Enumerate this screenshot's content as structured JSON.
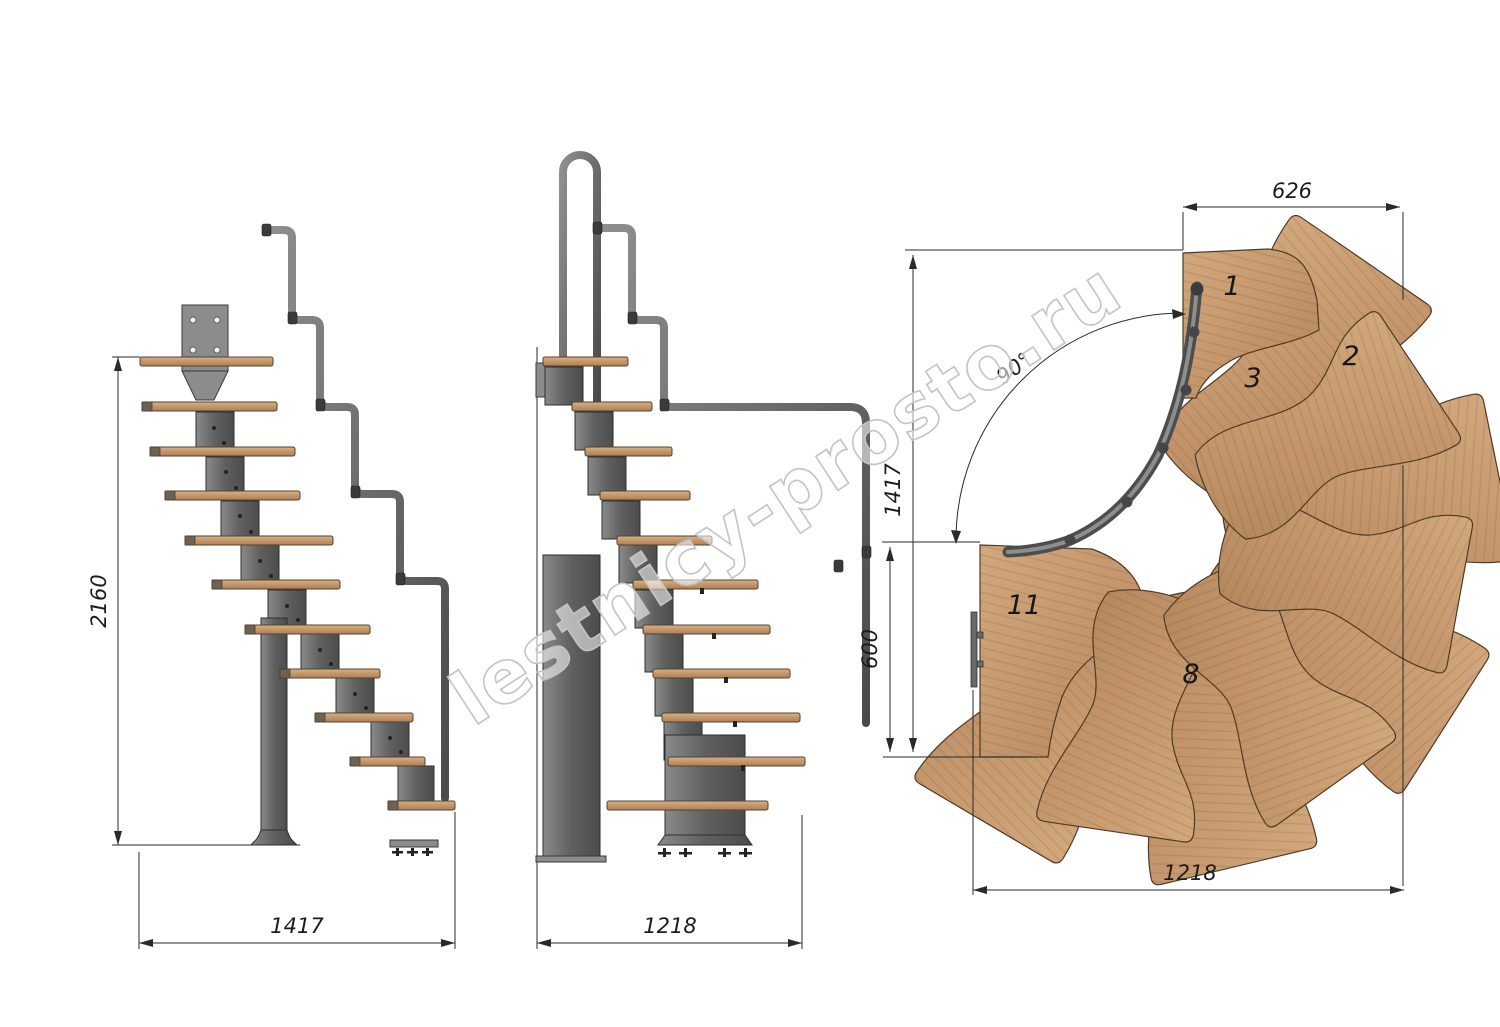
{
  "watermark": {
    "text": "lestnicy-prosto.ru"
  },
  "colors": {
    "wood": "#c79c74",
    "wood-dark": "#a97f57",
    "wood-edge": "#55422e",
    "metal": "#707070",
    "metal-dark": "#3f3f3f",
    "metal-light": "#9a9a9a",
    "line": "#2a2a2a",
    "dim-text": "#1c1c1c",
    "watermark": "#c4c4c4"
  },
  "side_view_a": {
    "dim_height": "2160",
    "dim_width": "1417"
  },
  "side_view_b": {
    "dim_width": "1218"
  },
  "plan_view": {
    "dim_top_width": "626",
    "dim_side_height": "1417",
    "dim_entry_height": "600",
    "dim_bottom_width": "1218",
    "turn_angle": "90°",
    "tread_numbers": {
      "n1": "1",
      "n2": "2",
      "n3": "3",
      "n8": "8",
      "n11": "11"
    }
  }
}
